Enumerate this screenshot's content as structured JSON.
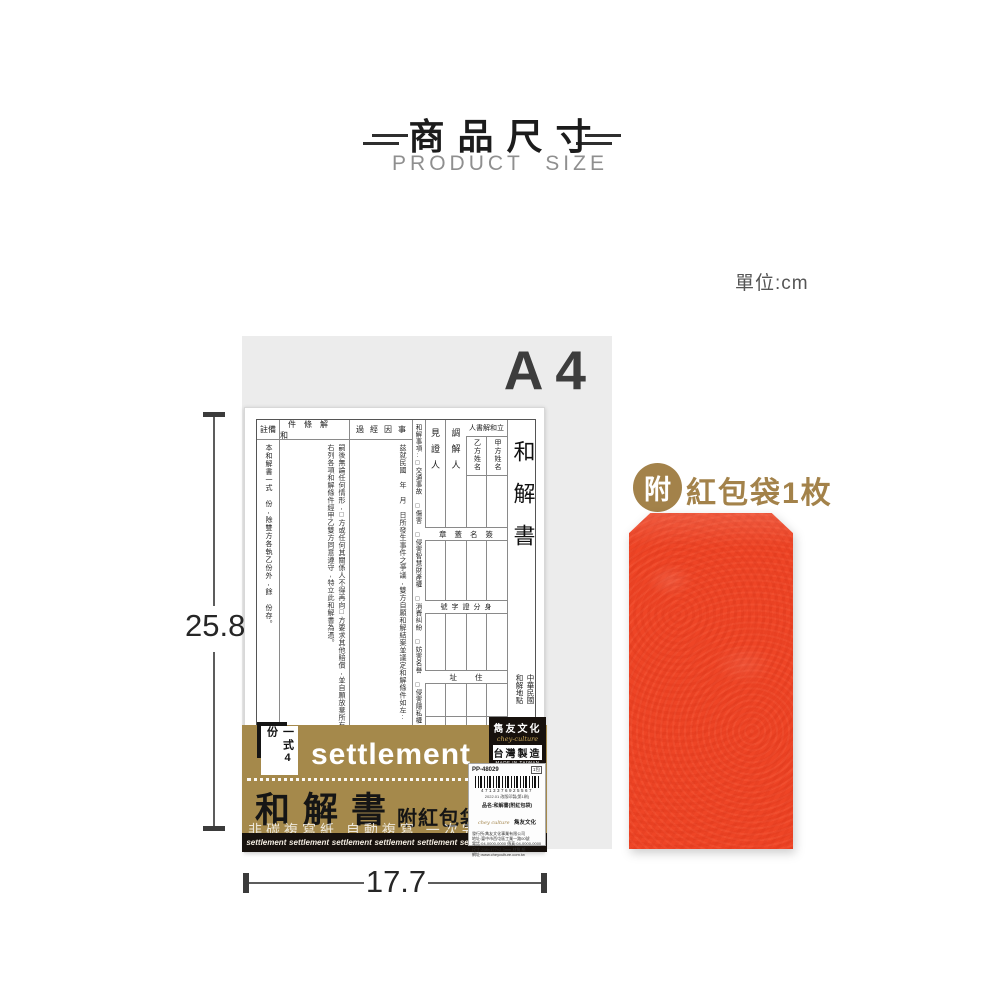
{
  "header": {
    "title": "商品尺寸",
    "subtitle": "PRODUCT SIZE",
    "unit_label": "單位:cm"
  },
  "diagram": {
    "paper_size": "A4",
    "height_value": "25.8",
    "width_value": "17.7"
  },
  "form": {
    "title": "和解書",
    "era_line": "中華民國",
    "place_line": "和解地點",
    "parties_header": "人書解和立",
    "party_a": "甲方姓名",
    "party_b": "乙方姓名",
    "mediator": "調解人",
    "witness": "見證人",
    "matters": "和解事項:□交通事故 □傷害 □侵害智慧財產權 □消費糾紛 □妨害名譽 □侵害隱私權 □網路糾紛",
    "course_header": "過經因事",
    "course_body": "茲就民國　年　月　日所發生事件之爭議,雙方自願和解結案並議定和解條件如左:",
    "conditions_header": "件條解和",
    "conditions_body_1": "嗣後無論任何情形,□方或任何其關係人不得再向□方要求其他賠償,並自願放棄所有一切民、刑事追訴權。",
    "conditions_body_2": "右列各項和解條件經甲乙雙方同意遵守,特立此和解書為憑。",
    "remarks_header": "註備",
    "remarks_body": "本和解書一式　份,除雙方各執乙份外,餘　份存。",
    "row_signature": "章蓋名簽",
    "row_id": "號字證分身",
    "row_address": "址住"
  },
  "package": {
    "copies": "一式4份",
    "brand_en": "settlement",
    "product_name": "和解書",
    "product_suffix": "附紅包袋",
    "features": "非碳複寫紙 自動複寫 一次完成",
    "strip_word": "settlement",
    "maker": {
      "name": "雋友文化",
      "script": "chey-culture",
      "made_in": "台灣製造",
      "made_in_en": "MADE IN TAIWAN"
    },
    "label": {
      "sku": "PP-48029",
      "pack": "1包",
      "barcode_digits": "4713376925567",
      "note_line": "2022.01 改版印製(第1刷)",
      "product_line": "品名:和解書(附紅包袋)",
      "brand_script": "chey culture",
      "brand_name": "雋友文化",
      "info_lines": [
        "發行所:雋友文化事業有限公司",
        "地址:臺中市西屯區工業一路00號",
        "電話:04-0000-0000 傳真:04-0000-0000",
        "尺寸:258×177×2.3mm 材質:紙",
        "網址:www.cheyculture.com.tw"
      ]
    }
  },
  "envelope": {
    "badge": "附",
    "label": "紅包袋1枚"
  },
  "colors": {
    "band_gold": "#a5894b",
    "envelope_red": "#ee4526",
    "badge_gold": "#a3824a",
    "gray_block": "#ececec",
    "strip_black": "#17110d"
  }
}
